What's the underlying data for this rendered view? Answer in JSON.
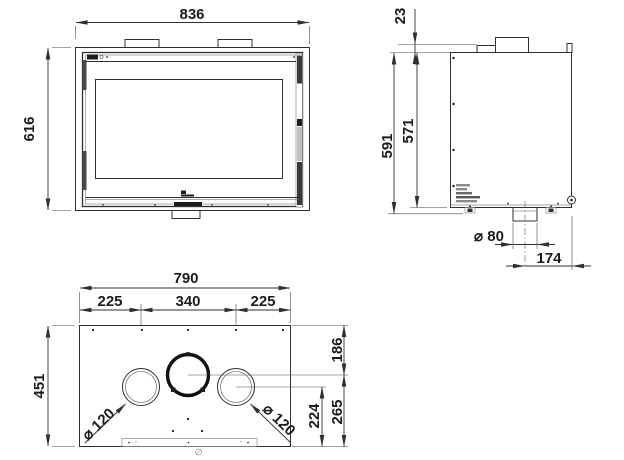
{
  "drawing": {
    "palette": {
      "line": "#2f2f2f",
      "text": "#1c1c1c",
      "background": "#ffffff"
    },
    "front_view": {
      "label": "front view",
      "overall_width_mm": "836",
      "overall_height_mm": "616"
    },
    "side_view": {
      "label": "side view",
      "top_frame_offset_mm": "23",
      "total_height_mm": "591",
      "body_height_mm": "571",
      "air_duct_diameter": "⌀ 80",
      "duct_center_to_front_mm": "174"
    },
    "top_view": {
      "label": "top view",
      "body_width_mm": "790",
      "left_outlet_offset_mm": "225",
      "outlet_spacing_mm": "340",
      "right_outlet_offset_mm": "225",
      "body_depth_mm": "451",
      "back_to_flue_center_mm": "186",
      "outlet_center_to_front_mm": "224",
      "flue_center_to_front_mm": "265",
      "left_outlet_diameter": "⌀ 120",
      "right_outlet_diameter": "⌀ 120"
    }
  }
}
